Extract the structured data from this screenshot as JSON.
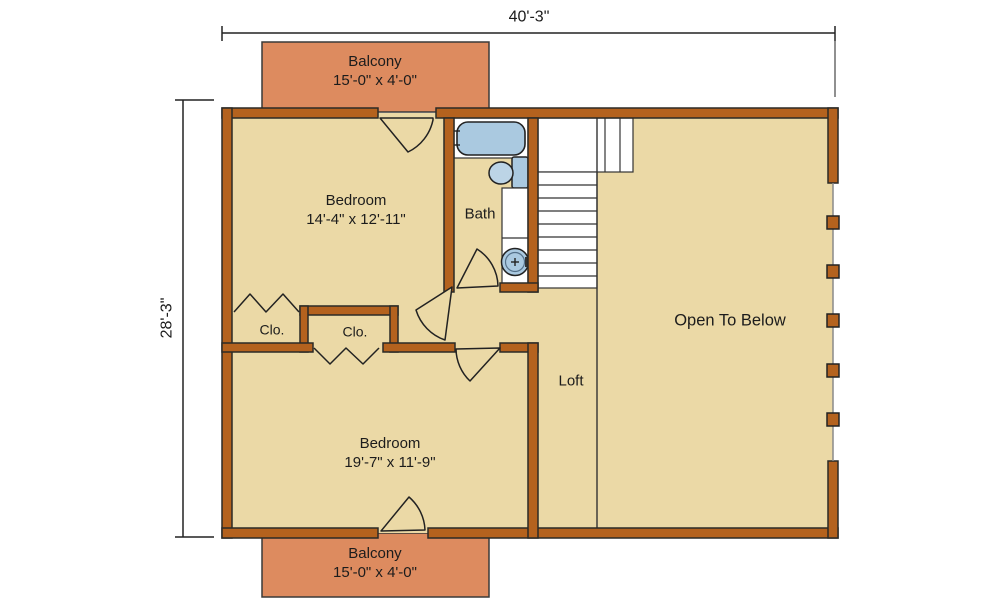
{
  "plan_title": "Second Floor Plan",
  "dimensions": {
    "overall_width": "40'-3\"",
    "overall_height": "28'-3\""
  },
  "rooms": {
    "balcony_top": {
      "label": "Balcony",
      "size": "15'-0\" x 4'-0\""
    },
    "bedroom_upper": {
      "label": "Bedroom",
      "size": "14'-4\" x 12'-11\""
    },
    "bath": {
      "label": "Bath"
    },
    "closet_left": {
      "label": "Clo."
    },
    "closet_right": {
      "label": "Clo."
    },
    "loft": {
      "label": "Loft"
    },
    "open_to_below": {
      "label": "Open To Below"
    },
    "bedroom_lower": {
      "label": "Bedroom",
      "size": "19'-7\" x 11'-9\""
    },
    "balcony_bottom": {
      "label": "Balcony",
      "size": "15'-0\" x 4'-0\""
    }
  },
  "fixtures": [
    "bathtub",
    "toilet",
    "vanity-sink",
    "staircase",
    "railing-posts"
  ],
  "colors": {
    "background": "#ffffff",
    "floor": "#ebd9a6",
    "wall": "#b4621e",
    "balcony": "#dd8b5f",
    "fixture": "#aac9e0",
    "fixture_light": "#bcd4e6",
    "outline": "#2b2a26"
  }
}
